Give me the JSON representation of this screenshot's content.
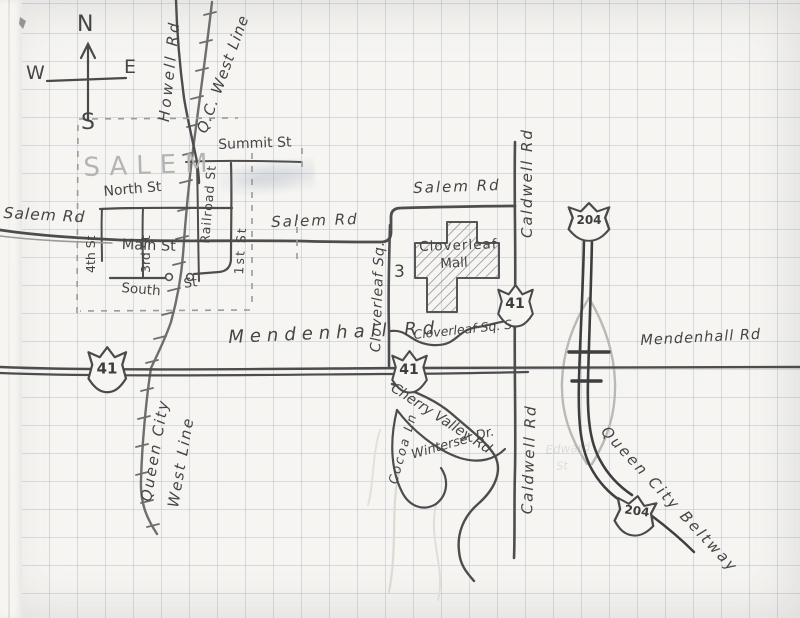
{
  "map_type": "hand-drawn pencil road map on graph paper",
  "colors": {
    "pencil": "#4a4a4a",
    "pencil_light": "#8f8f8f",
    "grid": "#c3cbd8",
    "paper": "#f6f5f2"
  },
  "compass": {
    "north": "N",
    "east": "E",
    "south": "S",
    "west": "W"
  },
  "town": {
    "name": "SALEM"
  },
  "shields": {
    "route41": "41",
    "route204": "204"
  },
  "labels": {
    "howell_rd": "Howell Rd",
    "qc_west_line": "Q.C. West Line",
    "queen_city": "Queen City",
    "west_line": "West Line",
    "summit_st": "Summit St",
    "north_st": "North St",
    "main_st": "Main St",
    "south_st": "South",
    "south_st_suffix": "St",
    "first_st": "1st St",
    "third_st": "3rd St",
    "fourth_st": "4th St",
    "railroad_st": "Railroad St",
    "salem_rd_west": "Salem Rd",
    "salem_rd_mid": "Salem Rd",
    "salem_rd_east": "Salem Rd",
    "cloverleaf_sq": "Cloverleaf Sq.",
    "cloverleaf_sq_s": "Cloverleaf Sq. S.",
    "mall_line1": "Cloverleaf",
    "mall_line2": "Mall",
    "mall_number": "3",
    "caldwell_rd_upper": "Caldwell Rd",
    "caldwell_rd_lower": "Caldwell Rd",
    "mendenhall_rd_west": "Mendenhall Rd",
    "mendenhall_rd_east": "Mendenhall Rd",
    "cherry_valley_rd": "Cherry Valley Rd",
    "winterset_dr": "Winterset Dr.",
    "cocoa_ln": "Cocoa Ln",
    "queen_city_beltway": "Queen City Beltway",
    "ghost_erased_line1": "Edward",
    "ghost_erased_line2": "St"
  }
}
